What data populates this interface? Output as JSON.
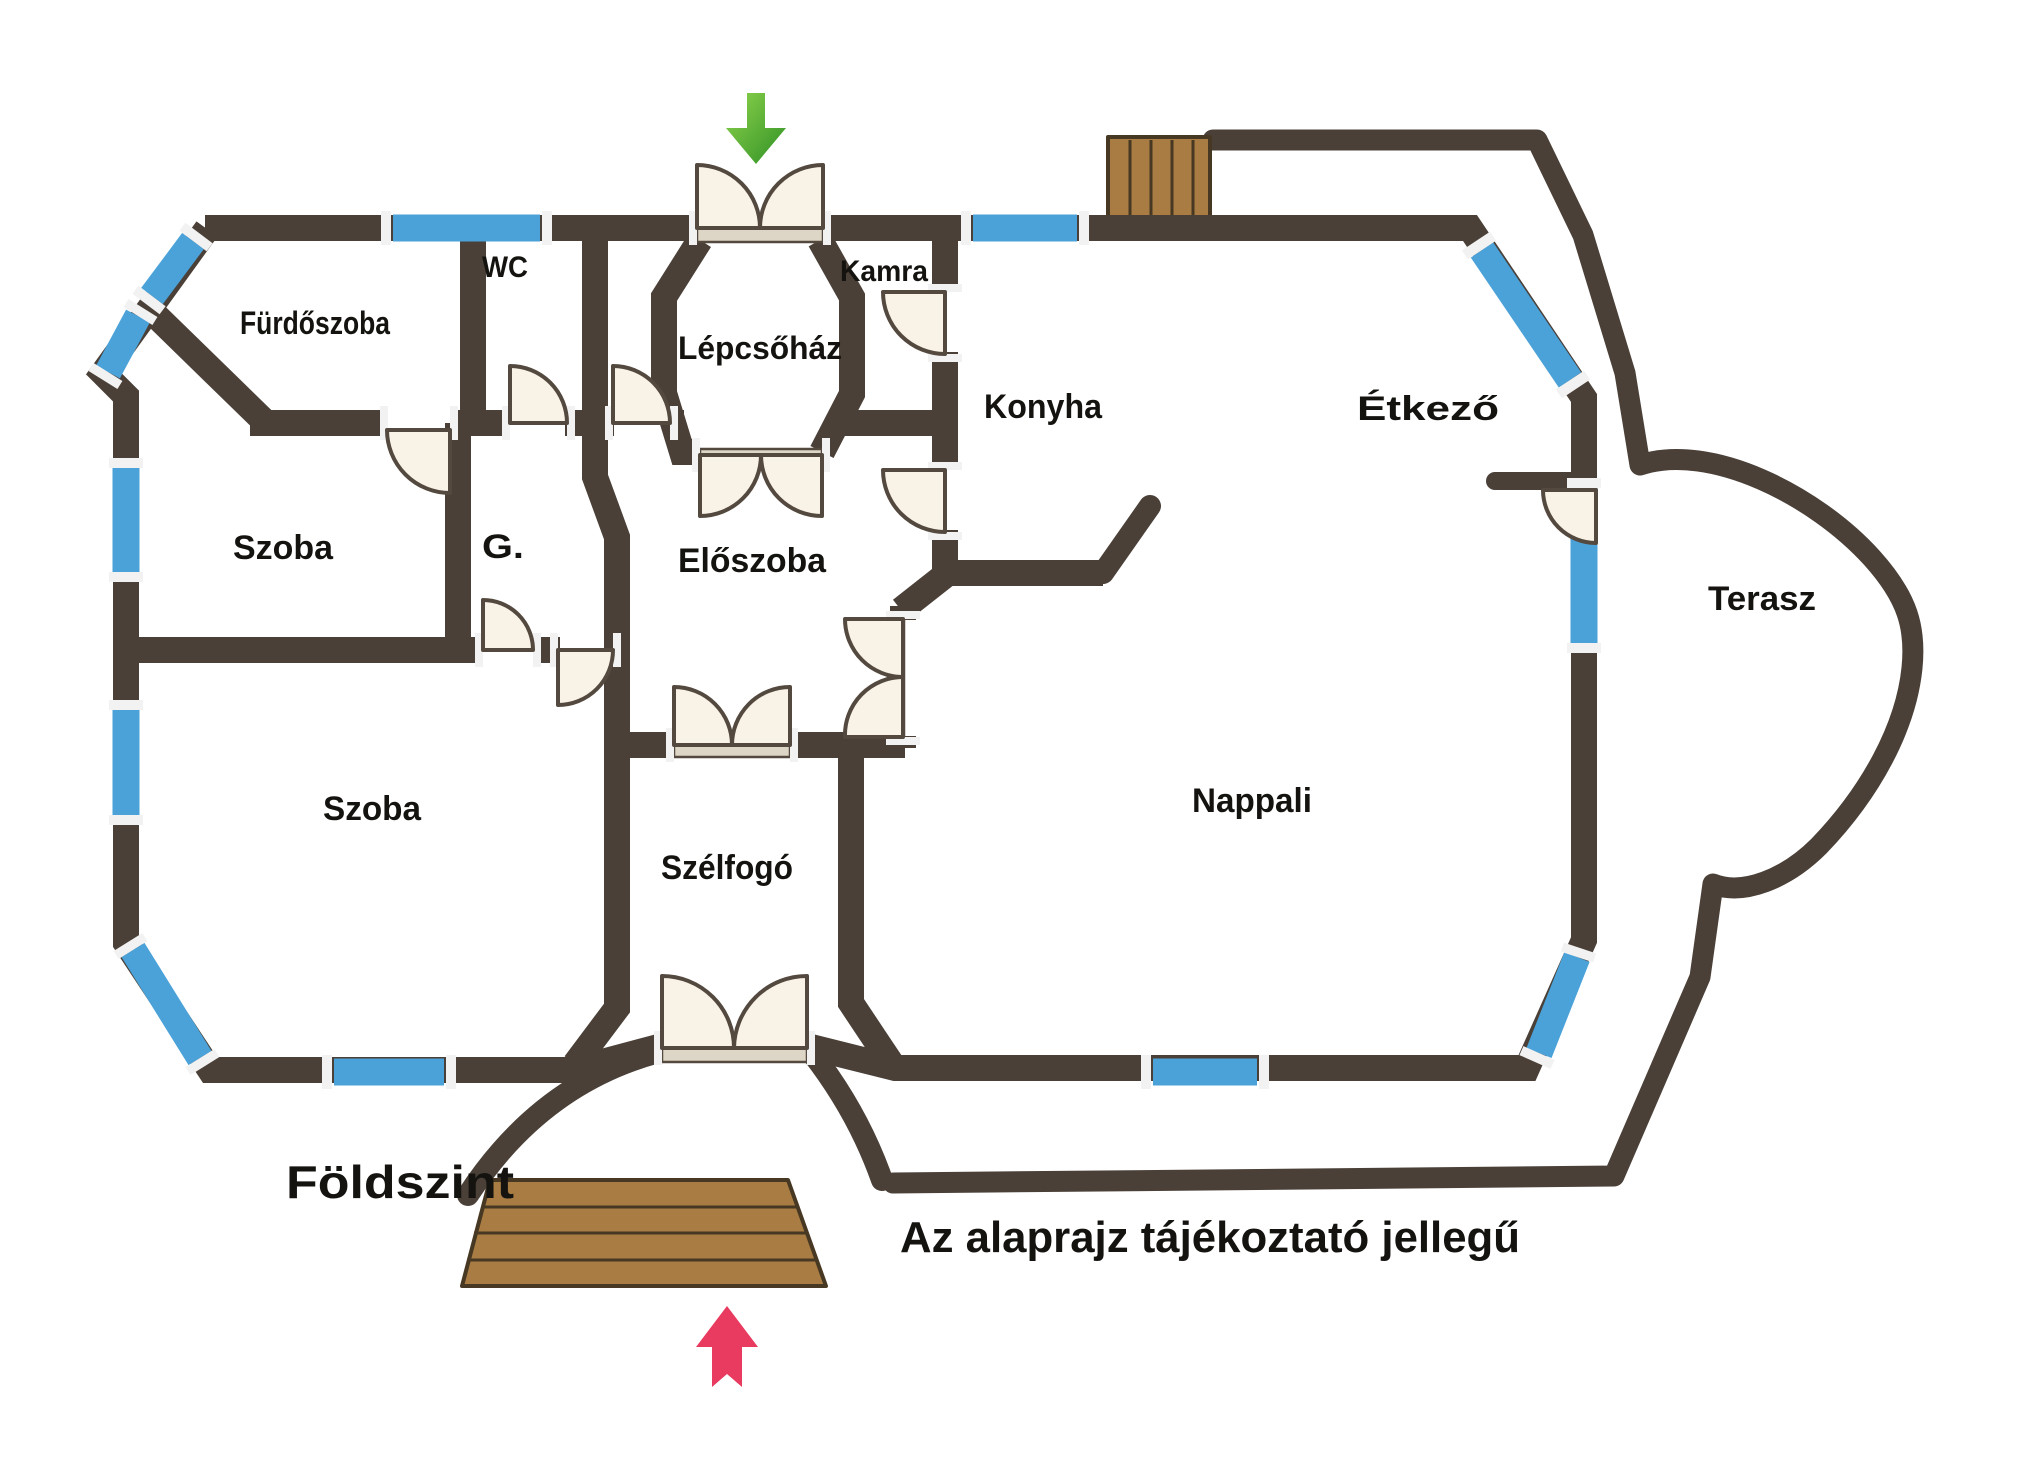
{
  "title": "Földszint",
  "note": "Az alaprajz tájékoztató jellegű",
  "rooms": {
    "furdoszoba": "Fürdőszoba",
    "wc": "WC",
    "kamra": "Kamra",
    "lepcsohaz": "Lépcsőház",
    "konyha": "Konyha",
    "etkezo": "Étkező",
    "szoba_felso": "Szoba",
    "gardrob": "G.",
    "eloszoba": "Előszoba",
    "szoba_also": "Szoba",
    "szelfogo": "Szélfogó",
    "nappali": "Nappali",
    "terasz": "Terasz"
  },
  "icons": {
    "top_entrance": "green-arrow-down-icon",
    "bottom_entrance": "red-arrow-up-icon"
  },
  "colors": {
    "bg": "#ffffff",
    "wall": "#4a4038",
    "window": "#4ba2d9",
    "window_cap": "#f2f2f2",
    "door": "#f9f2e6",
    "door_stroke": "#54493f",
    "threshold": "#ddd5c5",
    "wood": "#a87c42",
    "wood_line": "#473823",
    "arrow_green": "#47a42e",
    "arrow_green_light": "#8fd44e",
    "arrow_red": "#e93a5f",
    "text": "#151310"
  }
}
